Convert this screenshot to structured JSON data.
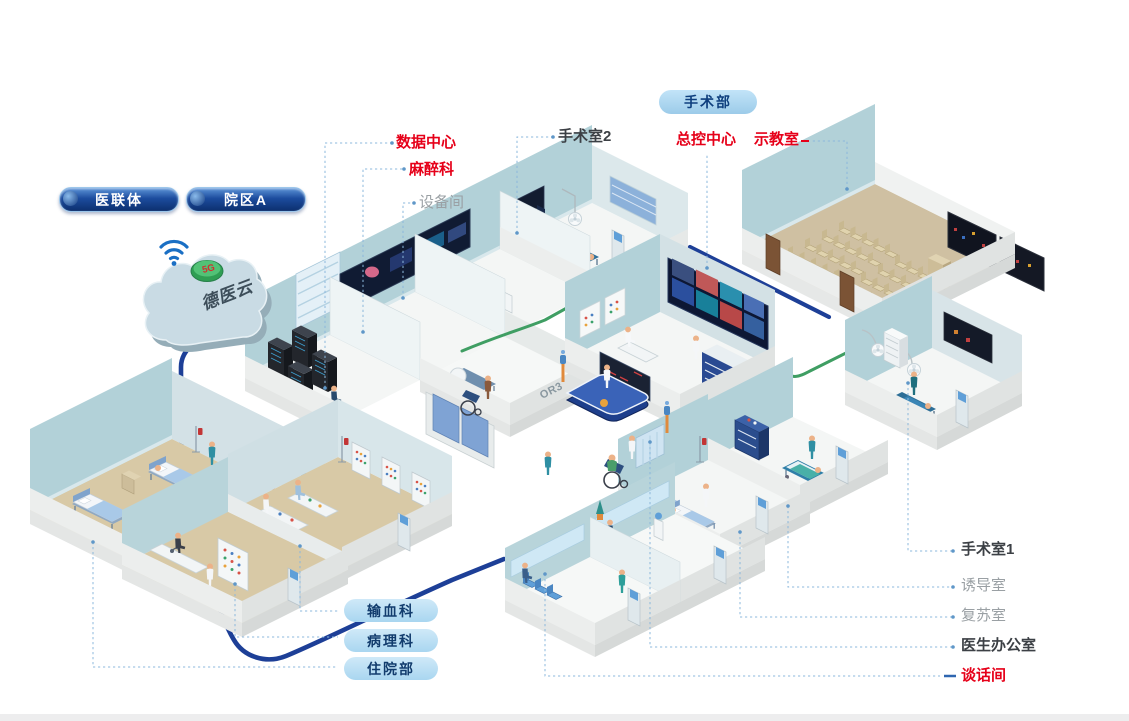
{
  "page": {
    "background": "#ffffff",
    "footer_strip_color": "#ededee"
  },
  "colors": {
    "label_red": "#e60019",
    "label_dark": "#3c4045",
    "label_gray": "#9aa0a4",
    "leader_line": "#8cb8dc",
    "cable_navy": "#1d3f97",
    "cable_green": "#3f9e63",
    "pill_navy": "#0c2f6e",
    "pill_light_blue": "#a9d6f0",
    "wall_teal": "#b2d1d8",
    "floor_tan": "#d5c6a2",
    "cloud_fill": "#c9dbe4",
    "badge_green": "#2f9e53"
  },
  "cloud": {
    "label": "德医云",
    "badge": "5G"
  },
  "pills_top": [
    {
      "label": "医联体"
    },
    {
      "label": "院区A"
    }
  ],
  "surgery_pill": {
    "label": "手术部"
  },
  "bottom_pills": [
    {
      "label": "输血科"
    },
    {
      "label": "病理科"
    },
    {
      "label": "住院部"
    }
  ],
  "callouts": {
    "or2": {
      "label": "手术室2"
    },
    "data_center": {
      "label": "数据中心"
    },
    "anesthesia": {
      "label": "麻醉科"
    },
    "equipment_room": {
      "label": "设备间"
    },
    "master_control": {
      "label": "总控中心"
    },
    "demo_room": {
      "label": "示教室"
    },
    "or1": {
      "label": "手术室1"
    },
    "induction_room": {
      "label": "诱导室"
    },
    "recovery_room": {
      "label": "复苏室"
    },
    "doctor_office": {
      "label": "医生办公室"
    },
    "talk_room": {
      "label": "谈话间"
    }
  },
  "wall_texts": {
    "or2": "OR2",
    "or3": "OR3"
  }
}
